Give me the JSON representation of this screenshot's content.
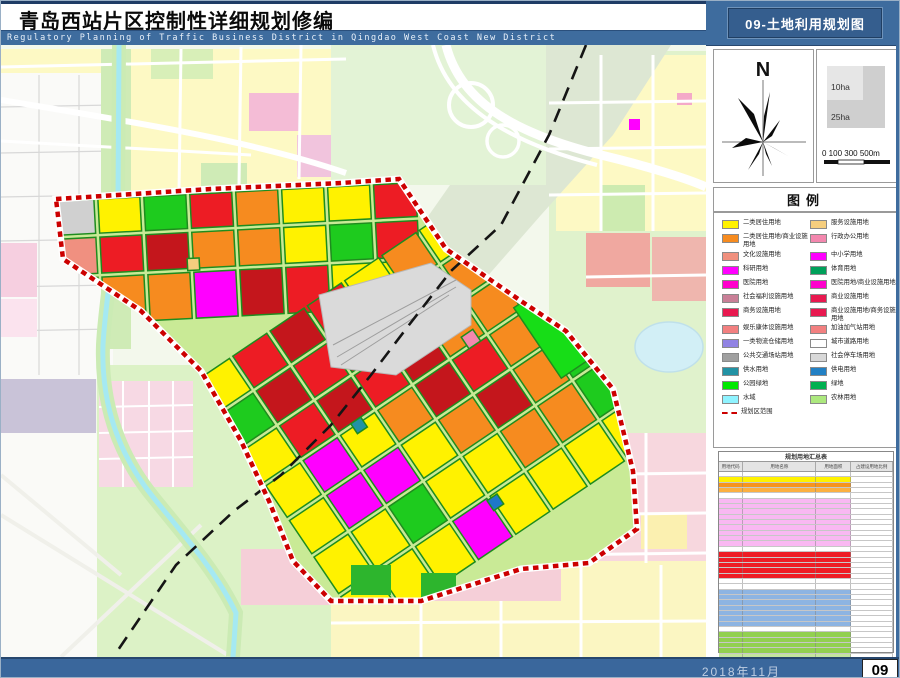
{
  "page": {
    "title": "青岛西站片区控制性详细规划修编",
    "subtitle_en": "Regulatory Planning of Traffic Business District in  Qingdao West Coast New District",
    "sheet_title": "09-土地利用规划图",
    "footer_date": "2018年11月",
    "page_number": "09"
  },
  "north": {
    "label": "N"
  },
  "scale": {
    "area_small": "10ha",
    "area_large": "25ha",
    "bar_labels": [
      "0 100",
      "300",
      "500m"
    ]
  },
  "legend": {
    "title": "图例",
    "items": [
      {
        "label": "二类居住用地",
        "color": "#FFF200"
      },
      {
        "label": "服务设施用地",
        "color": "#F6CE7E"
      },
      {
        "label": "二类居住用地/商业设施用地",
        "color": "#F68B1F"
      },
      {
        "label": "行政办公用地",
        "color": "#F387AE"
      },
      {
        "label": "文化设施用地",
        "color": "#F0907E"
      },
      {
        "label": "中小学用地",
        "color": "#FF00FF"
      },
      {
        "label": "科研用地",
        "color": "#FF00FF"
      },
      {
        "label": "体育用地",
        "color": "#00A05A"
      },
      {
        "label": "医院用地",
        "color": "#FF00CC"
      },
      {
        "label": "医院用地/商业设施用地",
        "color": "#FF00CC"
      },
      {
        "label": "社会福利设施用地",
        "color": "#C97F97"
      },
      {
        "label": "商业设施用地",
        "color": "#E81950"
      },
      {
        "label": "商务设施用地",
        "color": "#E81950"
      },
      {
        "label": "商业设施用地/商务设施用地",
        "color": "#E81950"
      },
      {
        "label": "娱乐康体设施用地",
        "color": "#F28080"
      },
      {
        "label": "加油加气站用地",
        "color": "#F28080"
      },
      {
        "label": "一类物流仓储用地",
        "color": "#9183E3"
      },
      {
        "label": "城市道路用地",
        "color": "#FFFFFF"
      },
      {
        "label": "公共交通场站用地",
        "color": "#A0A0A0"
      },
      {
        "label": "社会停车场用地",
        "color": "#D8D8D8"
      },
      {
        "label": "供水用地",
        "color": "#2292A4"
      },
      {
        "label": "供电用地",
        "color": "#2280C4"
      },
      {
        "label": "公园绿地",
        "color": "#00E800"
      },
      {
        "label": "绿地",
        "color": "#00B050"
      },
      {
        "label": "水域",
        "color": "#8FF3FF"
      },
      {
        "label": "农林用地",
        "color": "#ACE87E"
      },
      {
        "label": "规划区范围",
        "color": "#CC0000",
        "type": "dash"
      }
    ]
  },
  "table": {
    "title": "规划用地汇总表",
    "headers": [
      "用地代码",
      "用地名称",
      "用地面积",
      "占建设用地比例"
    ],
    "row_colors": [
      "#FFFFFF",
      "#FFF200",
      "#F7941D",
      "#FBB040",
      "#FFFFFF",
      "#F9B8F2",
      "#F9B8F2",
      "#F9B8F2",
      "#F9B8F2",
      "#F9B8F2",
      "#F9B8F2",
      "#F9B8F2",
      "#F9B8F2",
      "#F9B8F2",
      "#FFFFFF",
      "#EE1C25",
      "#EE1C25",
      "#EE1C25",
      "#EE1C25",
      "#EE1C25",
      "#FFFFFF",
      "#FFFFFF",
      "#8DB4E2",
      "#8DB4E2",
      "#8DB4E2",
      "#8DB4E2",
      "#8DB4E2",
      "#8DB4E2",
      "#8DB4E2",
      "#FFFFFF",
      "#92D050",
      "#92D050",
      "#92D050",
      "#92D050",
      "#C4E59F",
      "#FFFFFF",
      "#FFFFFF",
      "#FFFFFF",
      "#92E8F5",
      "#FFFFFF",
      "#76A832"
    ]
  }
}
